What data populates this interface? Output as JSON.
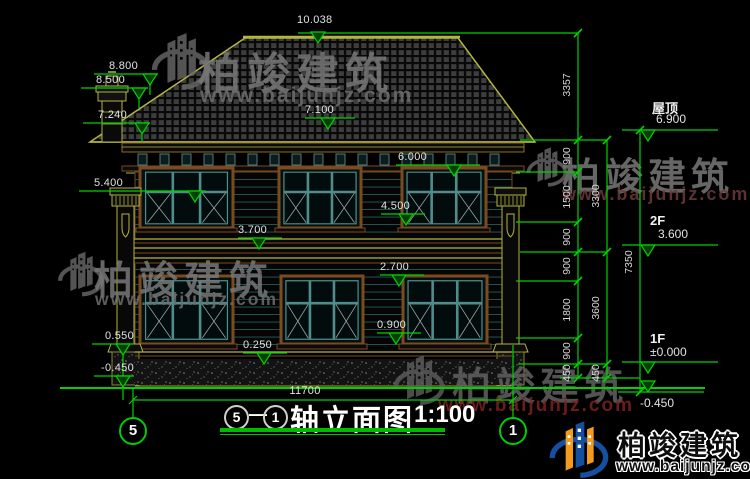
{
  "watermark": {
    "brand": "柏竣建筑",
    "url": "www.baijunjz.com"
  },
  "title_block": {
    "axis_start": "5",
    "axis_sep": "—",
    "axis_end": "1",
    "name": "轴立面图",
    "scale": "1:100"
  },
  "grid_bubbles": {
    "left": "5",
    "right": "1"
  },
  "dims": {
    "ridge": "10.038",
    "total_width": "11700",
    "left_markers": [
      "8.800",
      "8.500",
      "7.240",
      "5.400",
      "0.550",
      "-0.450"
    ],
    "mid_markers": [
      "7.100",
      "6.000",
      "4.500",
      "3.700",
      "2.700",
      "0.900",
      "0.250"
    ],
    "right_col1": [
      "3357",
      "900",
      "1500",
      "900",
      "900",
      "1800",
      "900",
      "450"
    ],
    "right_col2": [
      "3300",
      "3600",
      "450"
    ],
    "right_col3": [
      "7350"
    ],
    "levels": [
      {
        "label": "屋顶",
        "value": "6.900"
      },
      {
        "label": "2F",
        "value": "3.600"
      },
      {
        "label": "1F",
        "value": "±0.000"
      },
      {
        "label": "",
        "value": "-0.450"
      }
    ]
  },
  "colors": {
    "dim_green": "#00d200",
    "roof_olive": "#b4b440",
    "frame_brown": "#7a4a20",
    "window_teal": "#4f8d8d"
  }
}
